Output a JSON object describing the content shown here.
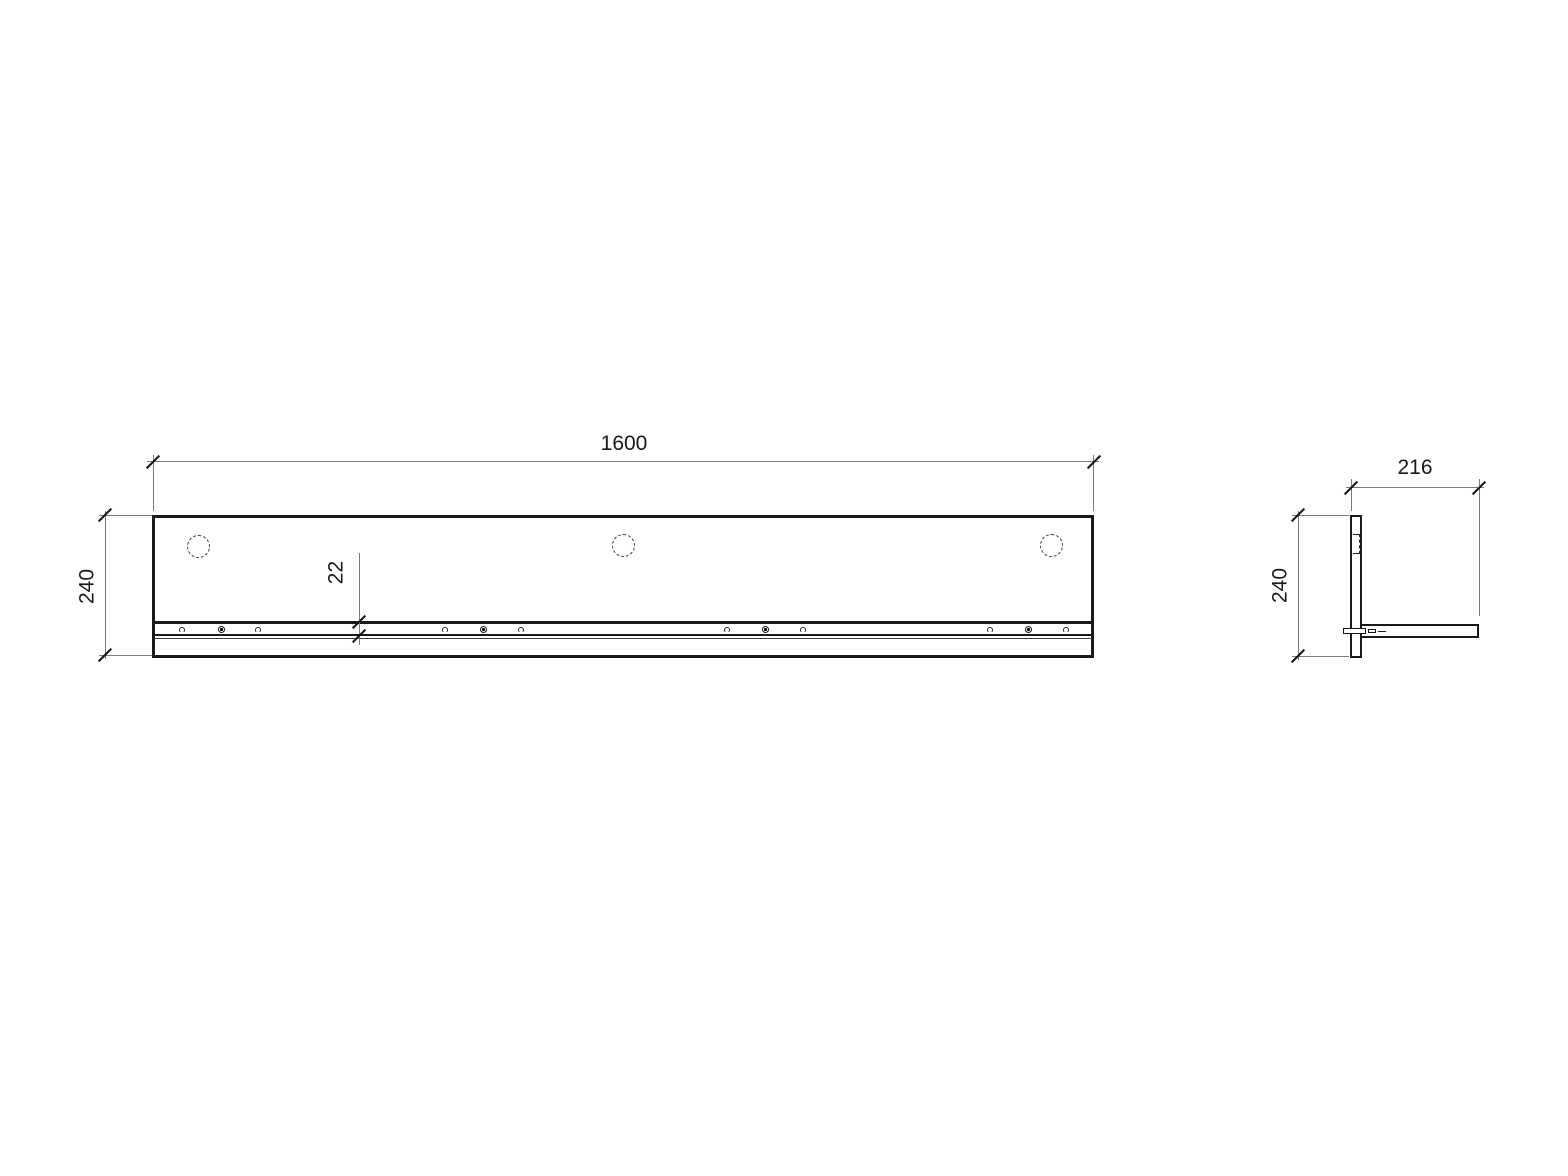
{
  "views": {
    "front": {
      "dim_width": "1600",
      "dim_height": "240",
      "dim_shelf_thickness": "22"
    },
    "side": {
      "dim_depth": "216",
      "dim_height": "240"
    }
  },
  "colors": {
    "outline": "#1a1a1a",
    "dimension_line": "#7a7a7a",
    "background": "#ffffff"
  }
}
